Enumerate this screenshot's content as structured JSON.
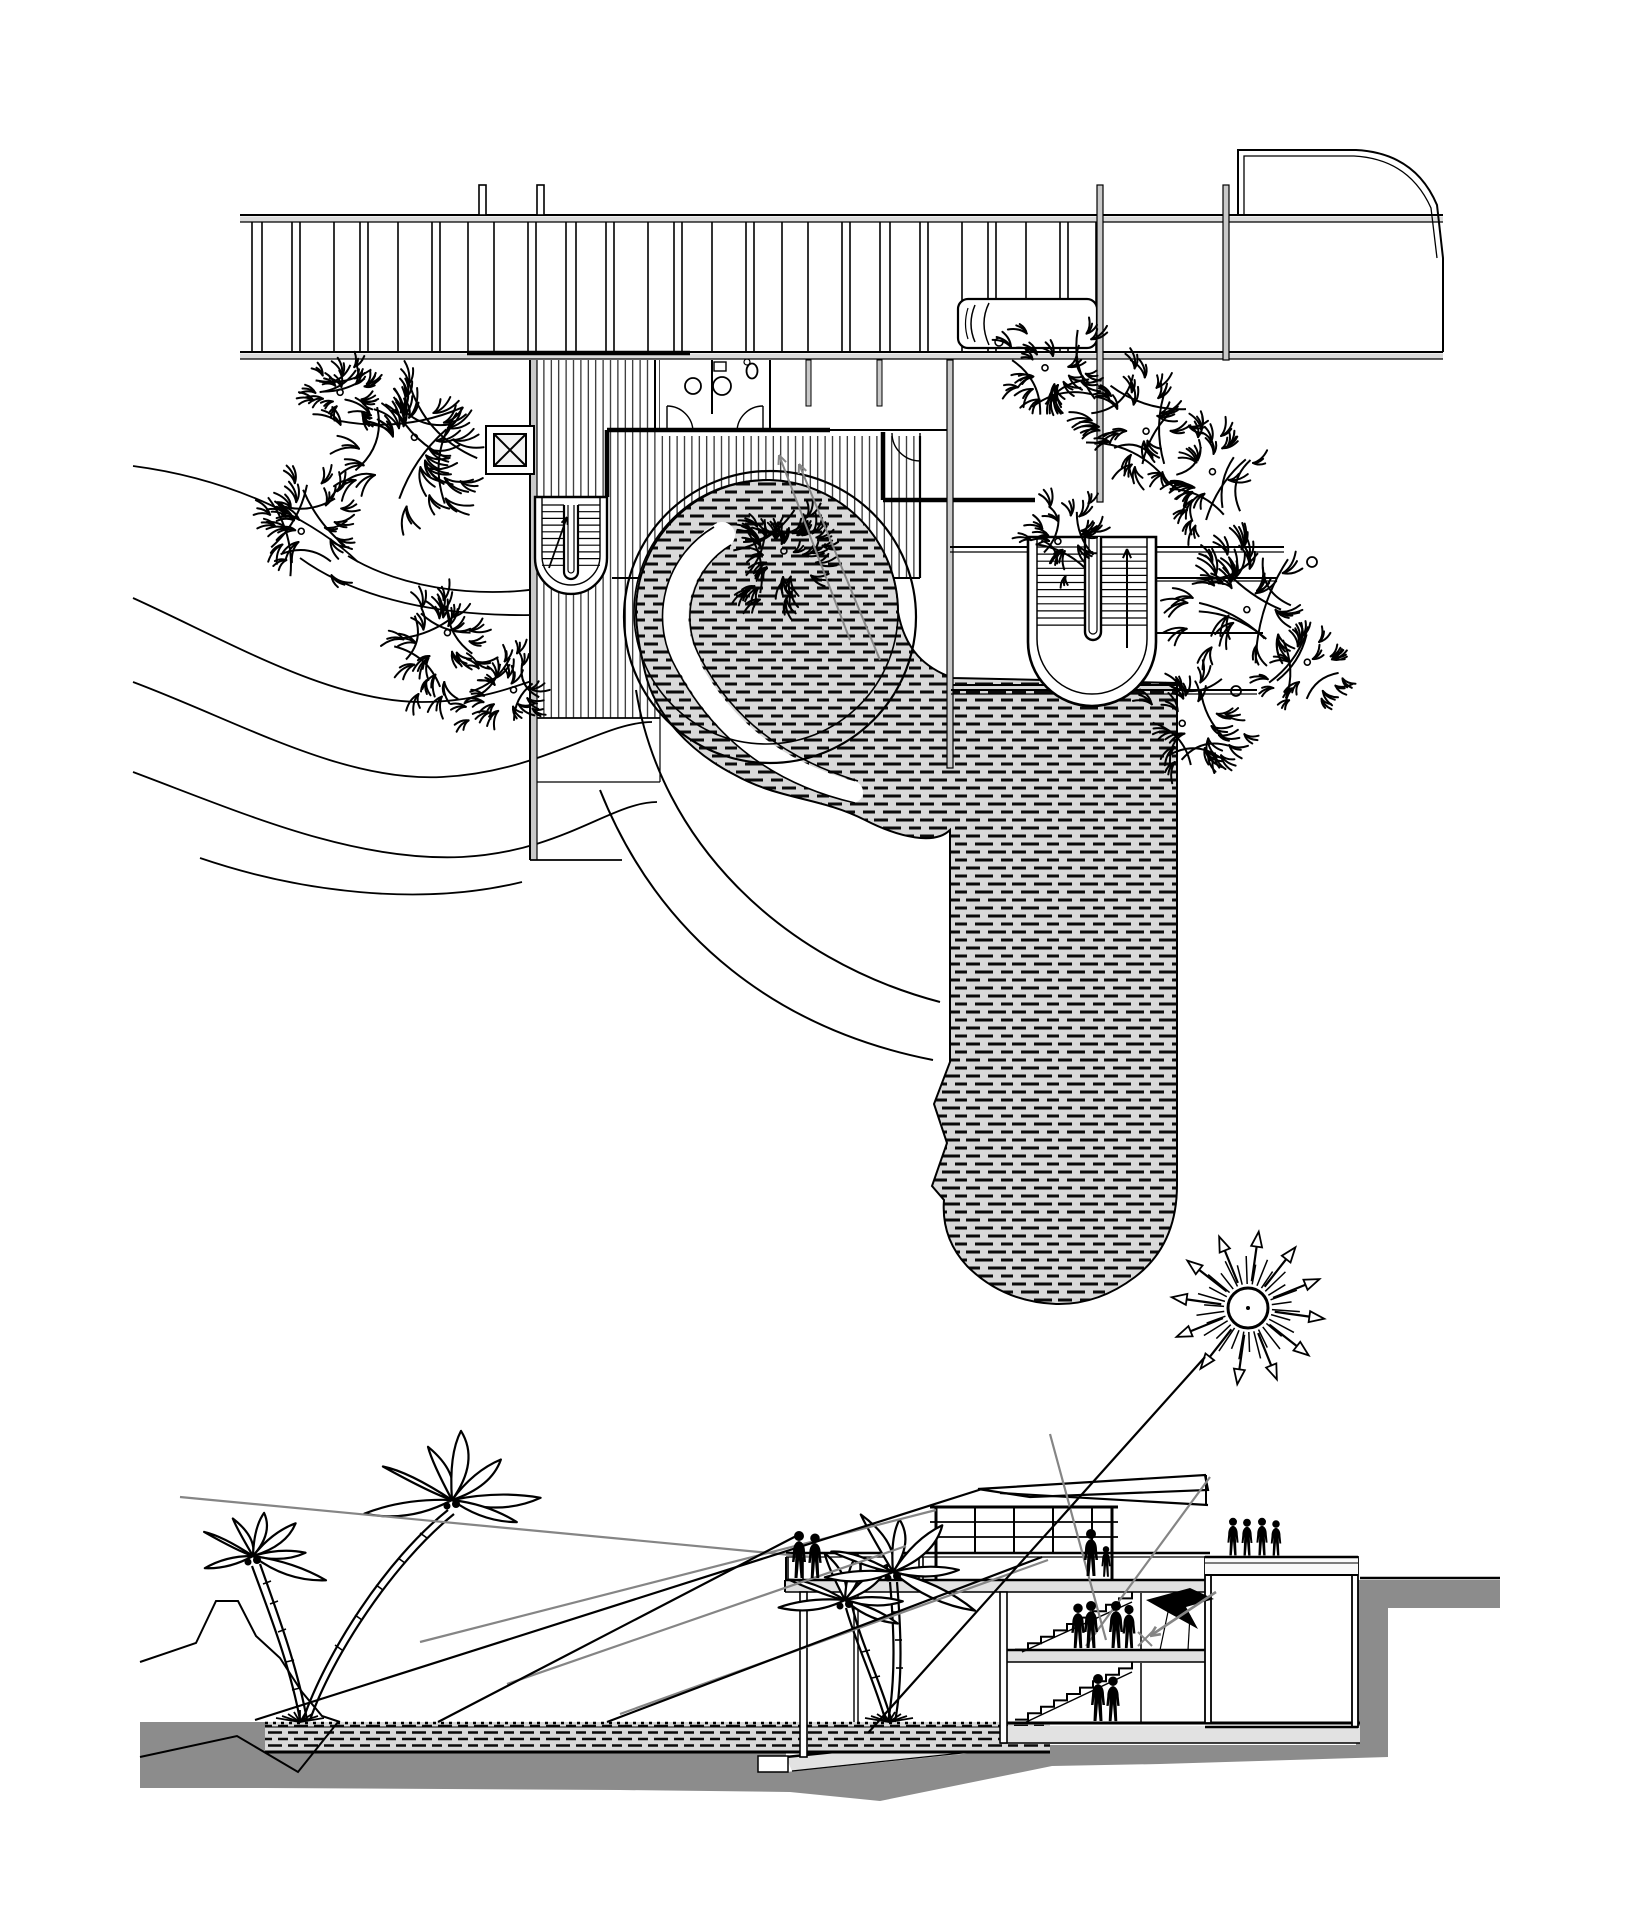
{
  "canvas": {
    "width": 1626,
    "height": 1926,
    "background": "#ffffff"
  },
  "colors": {
    "ink": "#000000",
    "terrain_gray": "#8c8c8c",
    "slab_gray": "#e2e2e2",
    "wall_gray": "#c9c9c9",
    "rail_gray": "#dcdcdc",
    "brick_bg": "#d9d9d9",
    "brick_dash": "#0a0a0a",
    "sightline_gray": "#858585",
    "panel_white": "#ffffff"
  },
  "views": {
    "plan": {
      "name": "site-plan"
    },
    "section": {
      "name": "beach-section"
    }
  },
  "symbols": {
    "sun": "starburst-with-arrow-rays",
    "plan_tree": "scribble-canopy",
    "palm_tree": "curved-trunk-palm",
    "person": "human-silhouette",
    "car": "parked-car-plan",
    "stair": "u-return-stair",
    "skylight": "crossed-square",
    "paving": "running-bond-brick-hatch",
    "decking": "vertical-plank-hatch"
  }
}
